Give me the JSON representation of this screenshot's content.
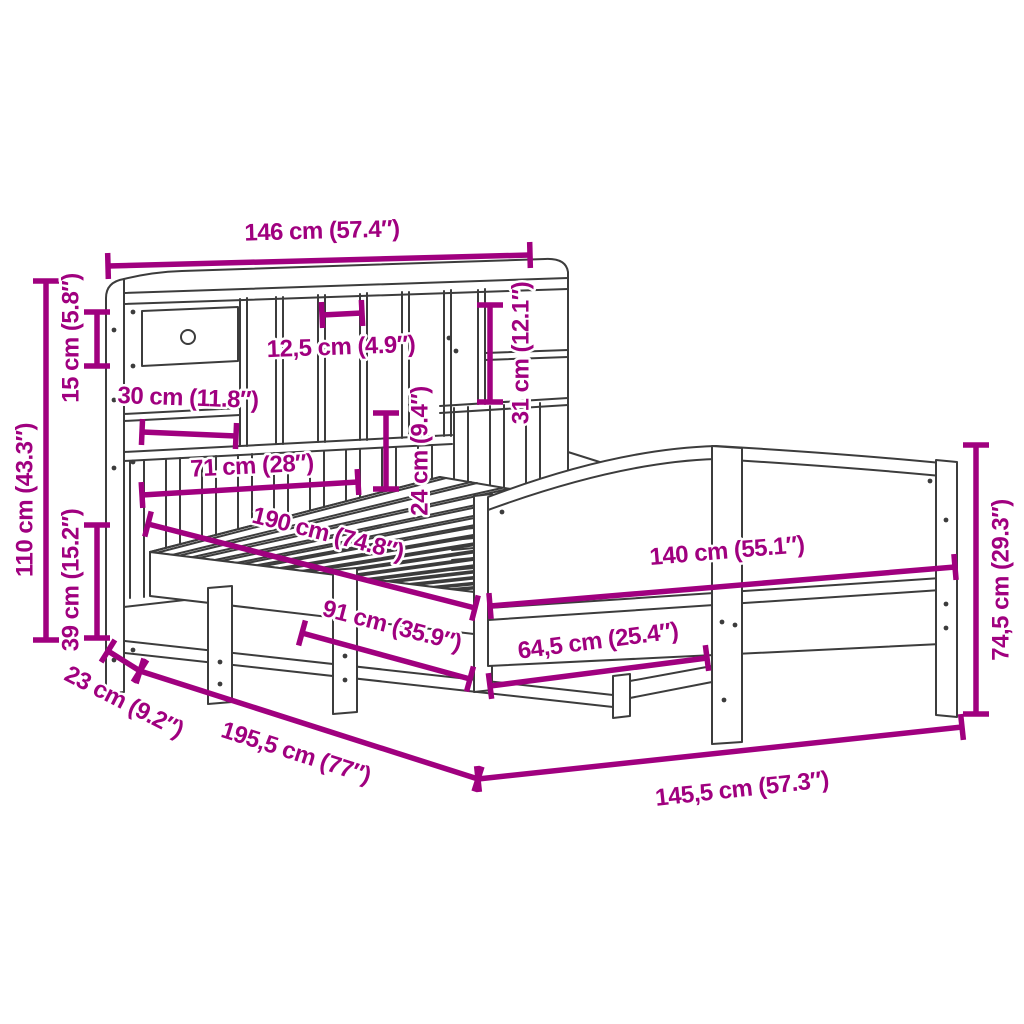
{
  "diagram": {
    "type": "product-dimension-diagram",
    "subject": "bookcase-bed-frame-line-drawing",
    "units": {
      "primary": "cm",
      "secondary": "inches"
    }
  },
  "colors": {
    "dimension": "#A0007F",
    "line_art": "#3C3C3C",
    "background": "#FFFFFF",
    "halo": "#FFFFFF"
  },
  "dimensions": [
    {
      "id": "headboard-width",
      "cm": "146",
      "in": "57.4",
      "label": "146 cm (57.4″)",
      "x1": 108,
      "y1": 266,
      "x2": 530,
      "y2": 255,
      "lx": 322,
      "ly": 231,
      "rot": -1.6
    },
    {
      "id": "headboard-height",
      "cm": "110",
      "in": "43.3",
      "label": "110 cm (43.3″)",
      "x1": 46,
      "y1": 281,
      "x2": 46,
      "y2": 640,
      "lx": 25,
      "ly": 500,
      "rot": -90
    },
    {
      "id": "top-shelf-height",
      "cm": "15",
      "in": "5.8",
      "label": "15 cm (5.8″)",
      "x1": 97,
      "y1": 312,
      "x2": 97,
      "y2": 366,
      "lx": 71,
      "ly": 338,
      "rot": -90
    },
    {
      "id": "lower-section-height",
      "cm": "39",
      "in": "15.2",
      "label": "39 cm (15.2″)",
      "x1": 97,
      "y1": 525,
      "x2": 97,
      "y2": 638,
      "lx": 71,
      "ly": 580,
      "rot": -90
    },
    {
      "id": "headboard-depth",
      "cm": "23",
      "in": "9.2",
      "label": "23 cm (9.2″)",
      "x1": 108,
      "y1": 651,
      "x2": 140,
      "y2": 671,
      "lx": 124,
      "ly": 702,
      "rot": 27
    },
    {
      "id": "total-length",
      "cm": "195,5",
      "in": "77",
      "label": "195,5 cm (77″)",
      "x1": 140,
      "y1": 671,
      "x2": 478,
      "y2": 779,
      "lx": 296,
      "ly": 753,
      "rot": 17.7
    },
    {
      "id": "total-width",
      "cm": "145,5",
      "in": "57.3",
      "label": "145,5 cm (57.3″)",
      "x1": 478,
      "y1": 779,
      "x2": 962,
      "y2": 727,
      "lx": 742,
      "ly": 789,
      "rot": -6.2
    },
    {
      "id": "footboard-height",
      "cm": "74,5",
      "in": "29.3",
      "label": "74,5 cm (29.3″)",
      "x1": 976,
      "y1": 445,
      "x2": 976,
      "y2": 714,
      "lx": 1001,
      "ly": 580,
      "rot": -90
    },
    {
      "id": "bed-width",
      "cm": "140",
      "in": "55.1",
      "label": "140 cm (55.1″)",
      "x1": 490,
      "y1": 606,
      "x2": 955,
      "y2": 567,
      "lx": 727,
      "ly": 551,
      "rot": -4.8
    },
    {
      "id": "footboard-leg-span",
      "cm": "64,5",
      "in": "25.4",
      "label": "64,5 cm (25.4″)",
      "x1": 490,
      "y1": 686,
      "x2": 707,
      "y2": 658,
      "lx": 598,
      "ly": 641,
      "rot": -7.3
    },
    {
      "id": "bed-length",
      "cm": "190",
      "in": "74.8",
      "label": "190 cm (74.8″)",
      "x1": 148,
      "y1": 524,
      "x2": 475,
      "y2": 608,
      "lx": 328,
      "ly": 534,
      "rot": 14.2
    },
    {
      "id": "side-rail-span",
      "cm": "91",
      "in": "35.9",
      "label": "91 cm (35.9″)",
      "x1": 302,
      "y1": 633,
      "x2": 470,
      "y2": 679,
      "lx": 392,
      "ly": 626,
      "rot": 14.5
    },
    {
      "id": "drawer-width",
      "cm": "30",
      "in": "11.8",
      "label": "30 cm (11.8″)",
      "x1": 142,
      "y1": 432,
      "x2": 236,
      "y2": 436,
      "lx": 188,
      "ly": 398,
      "rot": 2
    },
    {
      "id": "shelf-span",
      "cm": "71",
      "in": "28",
      "label": "71 cm (28″)",
      "x1": 142,
      "y1": 495,
      "x2": 358,
      "y2": 482,
      "lx": 252,
      "ly": 466,
      "rot": -3
    },
    {
      "id": "cubby-width",
      "cm": "12,5",
      "in": "4.9",
      "label": "12,5 cm (4.9″)",
      "x1": 322,
      "y1": 315,
      "x2": 362,
      "y2": 313,
      "lx": 341,
      "ly": 347,
      "rot": -2
    },
    {
      "id": "cubby-height",
      "cm": "31",
      "in": "12.1",
      "label": "31 cm (12.1″)",
      "x1": 490,
      "y1": 305,
      "x2": 490,
      "y2": 402,
      "lx": 521,
      "ly": 353,
      "rot": -90
    },
    {
      "id": "shelf-gap-height",
      "cm": "24",
      "in": "9.4",
      "label": "24 cm (9.4″)",
      "x1": 386,
      "y1": 413,
      "x2": 386,
      "y2": 489,
      "lx": 420,
      "ly": 451,
      "rot": -90
    }
  ]
}
